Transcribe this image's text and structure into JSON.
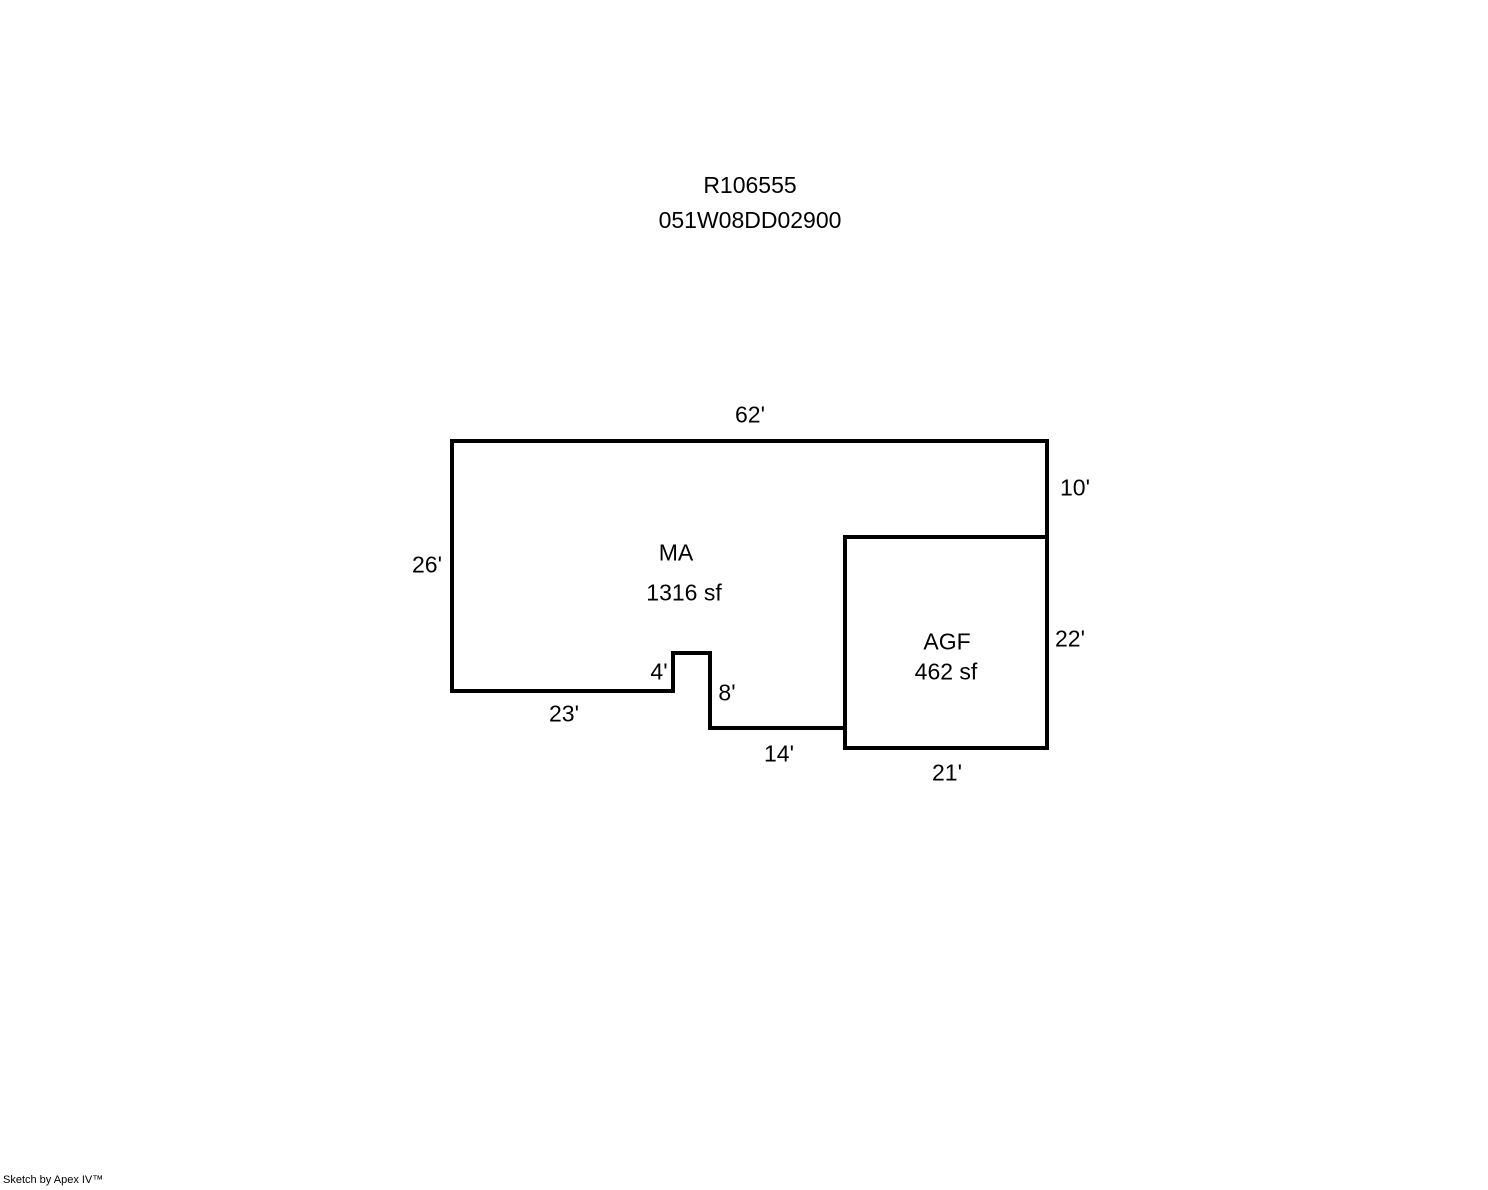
{
  "header": {
    "line1": "R106555",
    "line2": "051W08DD02900"
  },
  "areas": {
    "ma": {
      "code": "MA",
      "area": "1316 sf"
    },
    "agf": {
      "code": "AGF",
      "area": "462 sf"
    }
  },
  "dims": {
    "top62": "62'",
    "right10": "10'",
    "left26": "26'",
    "notch4": "4'",
    "notch8": "8'",
    "bottom23": "23'",
    "bottom14": "14'",
    "agf21": "21'",
    "agf22": "22'"
  },
  "footer": {
    "credit": "Sketch by Apex IV™"
  },
  "colors": {
    "line": "#000000",
    "background": "#ffffff",
    "text": "#000000"
  }
}
